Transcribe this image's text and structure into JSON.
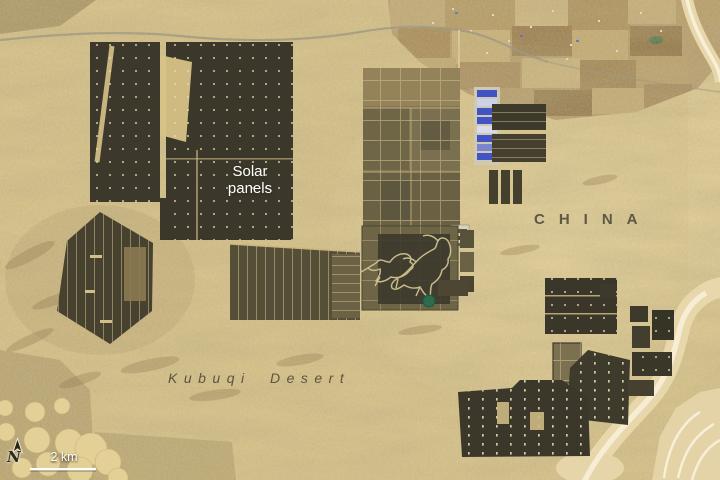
{
  "map": {
    "description": "Satellite image of solar panel arrays in the Kubuqi Desert, China",
    "labels": {
      "solar_panels": "Solar\npanels",
      "country": "CHINA",
      "desert": "Kubuqi Desert"
    },
    "scale_bar": {
      "label": "2 km"
    },
    "compass": {
      "label": "N"
    },
    "colors": {
      "sand": "#d7c287",
      "sand_light": "#ecdca6",
      "dune_shadow": "#9f8b59",
      "panel_dark": "#3b382b",
      "panel_olive": "#6e6546",
      "farmland": "#b49a68",
      "wash": "#e7d7ab",
      "river_white": "#f7f0d8",
      "building_blue": "#4253c4",
      "pond_green": "#2e6b4e",
      "label_dark": "#524c3b",
      "label_white": "#ffffff"
    }
  }
}
